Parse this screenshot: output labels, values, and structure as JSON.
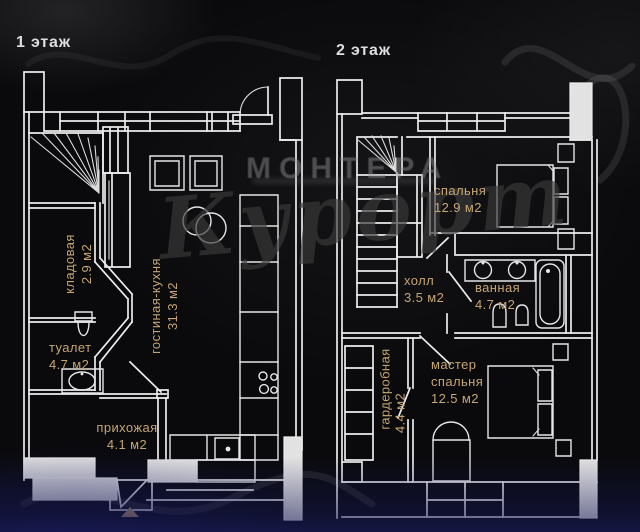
{
  "colors": {
    "background": "#0a0a0d",
    "line_white": "#ececec",
    "label_gold": "#c6a572",
    "watermark_gray": "#909090",
    "bottom_tint_navy": "#16185a"
  },
  "watermark": {
    "brand": "МОНТЕРА",
    "script": "Курорт"
  },
  "floor1": {
    "title": "1 этаж",
    "rooms": [
      {
        "name": "кладовая",
        "area": "2.9 м2"
      },
      {
        "name": "туалет",
        "area": "4.7 м2"
      },
      {
        "name": "прихожая",
        "area": "4.1 м2"
      },
      {
        "name": "гостиная-кухня",
        "area": "31.3 м2"
      }
    ]
  },
  "floor2": {
    "title": "2 этаж",
    "rooms": [
      {
        "name": "спальня",
        "area": "12.9 м2"
      },
      {
        "name": "холл",
        "area": "3.5 м2"
      },
      {
        "name": "ванная",
        "area": "4.7 м2"
      },
      {
        "name": "гардеробная",
        "area": "4.4 м2"
      },
      {
        "name": "мастер спальня",
        "area": "12.5 м2"
      }
    ]
  }
}
